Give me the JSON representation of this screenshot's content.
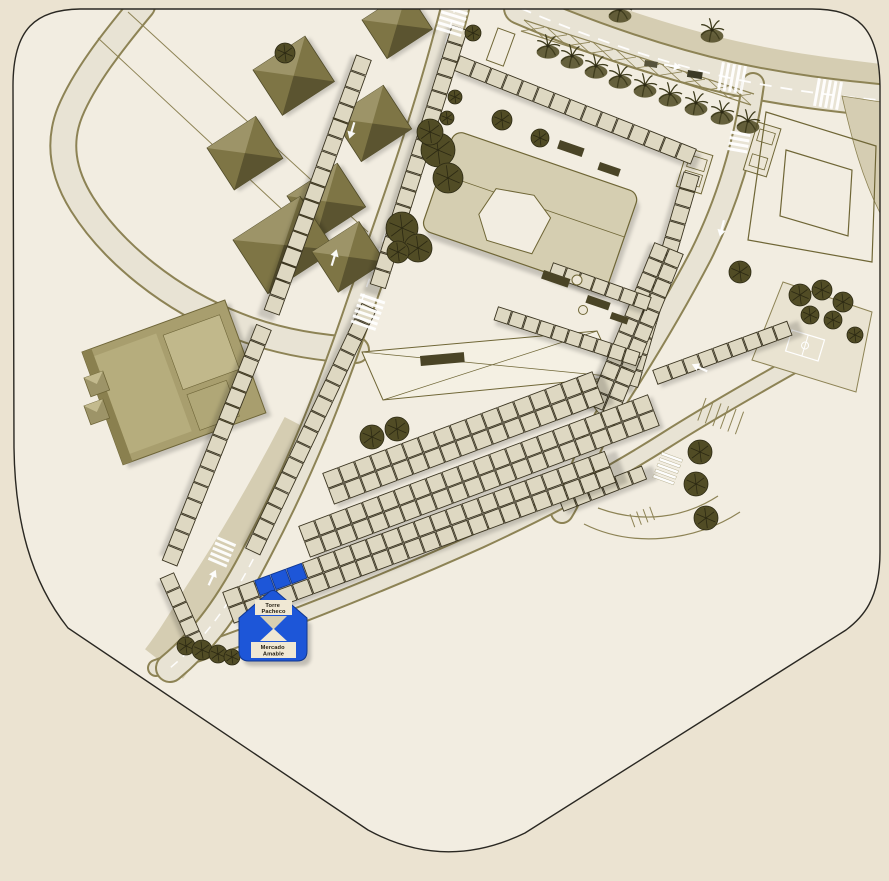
{
  "marker": {
    "title": "Torre Pacheco",
    "subtitle": "Mercado Amable",
    "title_lines": [
      "Torre",
      "Pacheco"
    ],
    "subtitle_lines": [
      "Mercado",
      "Amable"
    ]
  },
  "palette": {
    "canvas_bg": "#ebe3d1",
    "map_fill": "#f2ede1",
    "outline": "#2a2822",
    "road_fill": "#e8e3d4",
    "road_edge": "#8d8355",
    "sidewalk_khaki": "#d5cdb2",
    "stall_fill": "#ded8c2",
    "stall_stroke": "#3a3420",
    "plaza_fill": "#d5ceb1",
    "plaza_edge": "#6f6636",
    "roof_base": "#7e7545",
    "roof_light": "#9d9468",
    "roof_dark": "#5b5430",
    "warehouse": "#a89e6e",
    "warehouse_light": "#bdb485",
    "warehouse_edge": "#6e6538",
    "tree_dark": "#514c25",
    "tree_line": "#2c2913",
    "bench_dark": "#4a4426",
    "highlight_blue": "#1d56d8",
    "highlight_blue_dark": "#12388f",
    "label_bg": "#f0e8d4",
    "label_bg_dark": "#d8cfb2",
    "text_dark": "#211c10",
    "white": "#ffffff"
  }
}
